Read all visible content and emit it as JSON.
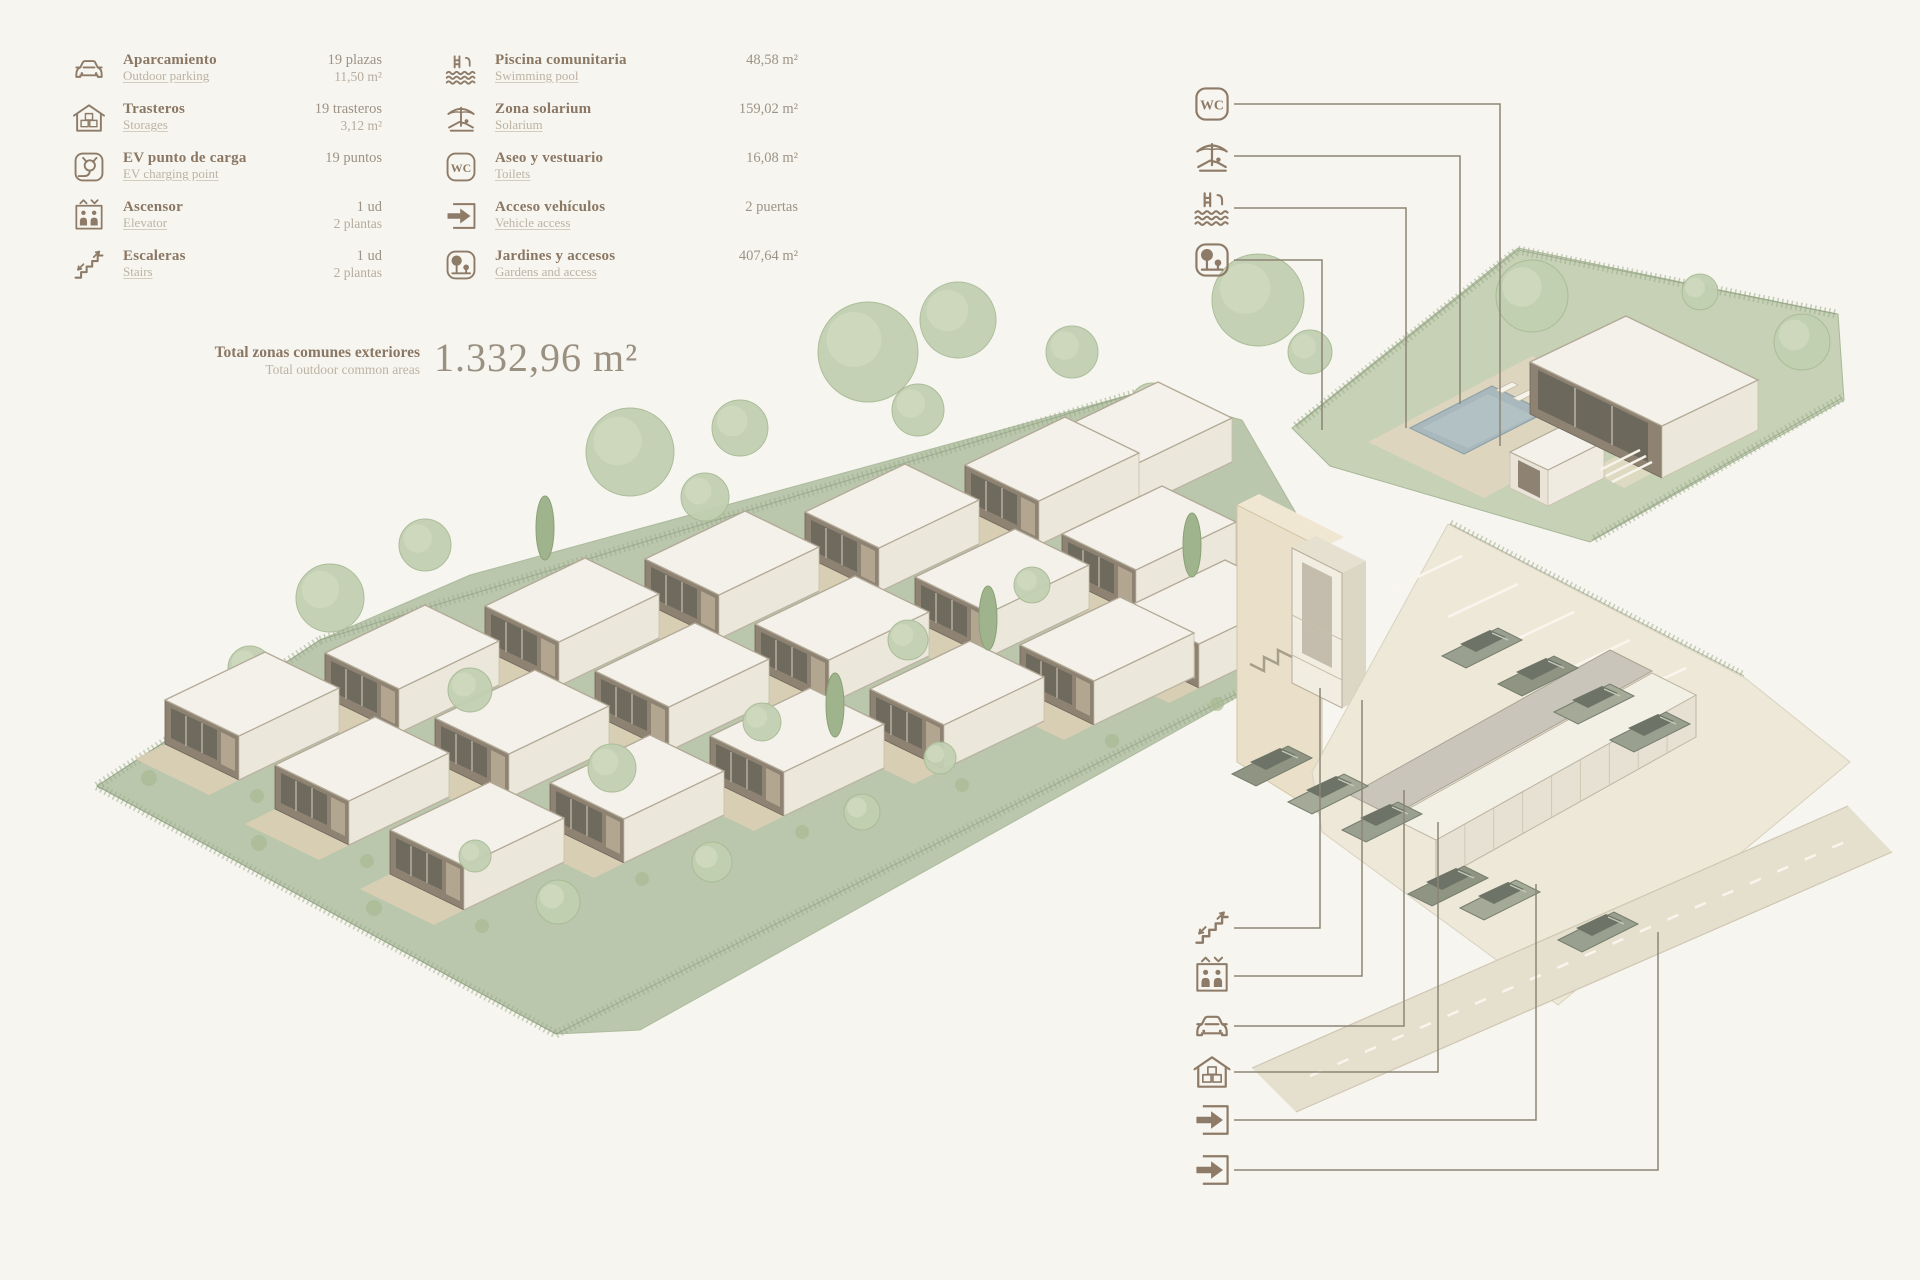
{
  "legend": {
    "col1": [
      {
        "icon": "car-icon",
        "title": "Aparcamiento",
        "subtitle": "Outdoor parking",
        "value1": "19 plazas",
        "value2": "11,50 m²"
      },
      {
        "icon": "storage-icon",
        "title": "Trasteros",
        "subtitle": "Storages",
        "value1": "19 trasteros",
        "value2": "3,12 m²"
      },
      {
        "icon": "ev-icon",
        "title": "EV punto de carga",
        "subtitle": "EV charging point",
        "value1": "19 puntos",
        "value2": ""
      },
      {
        "icon": "elevator-icon",
        "title": "Ascensor",
        "subtitle": "Elevator",
        "value1": "1 ud",
        "value2": "2 plantas"
      },
      {
        "icon": "stairs-icon",
        "title": "Escaleras",
        "subtitle": "Stairs",
        "value1": "1 ud",
        "value2": "2 plantas"
      }
    ],
    "col2": [
      {
        "icon": "pool-icon",
        "title": "Piscina comunitaria",
        "subtitle": "Swimming pool",
        "value1": "48,58 m²",
        "value2": ""
      },
      {
        "icon": "solarium-icon",
        "title": "Zona solarium",
        "subtitle": "Solarium",
        "value1": "159,02 m²",
        "value2": ""
      },
      {
        "icon": "wc-icon",
        "title": "Aseo y vestuario",
        "subtitle": "Toilets",
        "value1": "16,08 m²",
        "value2": ""
      },
      {
        "icon": "vehicle-access-icon",
        "title": "Acceso vehículos",
        "subtitle": "Vehicle access",
        "value1": "2 puertas",
        "value2": ""
      },
      {
        "icon": "garden-icon",
        "title": "Jardines y accesos",
        "subtitle": "Gardens and access",
        "value1": "407,64 m²",
        "value2": ""
      }
    ],
    "total": {
      "title": "Total zonas comunes exteriores",
      "subtitle": "Total outdoor common areas",
      "value": "1.332,96 m²"
    }
  },
  "colors": {
    "accent_brown": "#8d7b68",
    "terrain_green": "#bac7ac",
    "tree_green": "#c2d0b2",
    "roof_white": "#f4f1ea",
    "pool_blue": "#a9b8bd",
    "wall_beige": "#eadfc8",
    "car_grey": "#9aa08f",
    "line": "#8b8575"
  },
  "callouts": {
    "top": [
      {
        "icon": "wc-icon",
        "line": [
          [
            1234,
            104
          ],
          [
            1500,
            104
          ],
          [
            1500,
            446
          ]
        ]
      },
      {
        "icon": "solarium-icon",
        "line": [
          [
            1234,
            156
          ],
          [
            1460,
            156
          ],
          [
            1460,
            404
          ]
        ]
      },
      {
        "icon": "pool-icon",
        "line": [
          [
            1234,
            208
          ],
          [
            1406,
            208
          ],
          [
            1406,
            428
          ]
        ]
      },
      {
        "icon": "garden-icon",
        "line": [
          [
            1234,
            260
          ],
          [
            1322,
            260
          ],
          [
            1322,
            430
          ]
        ]
      }
    ],
    "bottom": [
      {
        "icon": "stairs-icon",
        "line": [
          [
            1234,
            928
          ],
          [
            1320,
            928
          ],
          [
            1320,
            688
          ]
        ]
      },
      {
        "icon": "elevator-icon",
        "line": [
          [
            1234,
            976
          ],
          [
            1362,
            976
          ],
          [
            1362,
            700
          ]
        ]
      },
      {
        "icon": "car-icon",
        "line": [
          [
            1234,
            1026
          ],
          [
            1404,
            1026
          ],
          [
            1404,
            790
          ]
        ]
      },
      {
        "icon": "storage-icon",
        "line": [
          [
            1234,
            1072
          ],
          [
            1438,
            1072
          ],
          [
            1438,
            822
          ]
        ]
      },
      {
        "icon": "vehicle-access-icon",
        "line": [
          [
            1234,
            1120
          ],
          [
            1536,
            1120
          ],
          [
            1536,
            884
          ]
        ]
      },
      {
        "icon": "vehicle-access-icon",
        "line": [
          [
            1234,
            1170
          ],
          [
            1658,
            1170
          ],
          [
            1658,
            932
          ]
        ]
      }
    ],
    "top_icon_x": 1190,
    "top_icon_ys": [
      82,
      134,
      186,
      238
    ],
    "bottom_icon_x": 1190,
    "bottom_icon_ys": [
      906,
      954,
      1004,
      1050,
      1098,
      1148
    ]
  },
  "site": {
    "band": [
      [
        97,
        786
      ],
      [
        320,
        640
      ],
      [
        470,
        575
      ],
      [
        1140,
        392
      ],
      [
        1242,
        420
      ],
      [
        1322,
        558
      ],
      [
        1300,
        662
      ],
      [
        640,
        1030
      ],
      [
        556,
        1034
      ]
    ],
    "community": [
      [
        1292,
        428
      ],
      [
        1518,
        248
      ],
      [
        1700,
        286
      ],
      [
        1838,
        314
      ],
      [
        1844,
        400
      ],
      [
        1590,
        542
      ],
      [
        1330,
        466
      ]
    ],
    "deck": [
      [
        1368,
        442
      ],
      [
        1532,
        356
      ],
      [
        1648,
        408
      ],
      [
        1484,
        498
      ]
    ],
    "pool": [
      [
        1410,
        428
      ],
      [
        1492,
        386
      ],
      [
        1546,
        412
      ],
      [
        1464,
        454
      ]
    ],
    "steps_patch": [
      [
        1590,
        470
      ],
      [
        1666,
        430
      ],
      [
        1700,
        448
      ],
      [
        1624,
        488
      ]
    ],
    "loungers": [
      [
        1496,
        390
      ],
      [
        1513,
        398
      ],
      [
        1530,
        407
      ],
      [
        1547,
        415
      ]
    ],
    "houses": [
      [
        165,
        700
      ],
      [
        325,
        653
      ],
      [
        485,
        606
      ],
      [
        645,
        559
      ],
      [
        805,
        512
      ],
      [
        965,
        465
      ],
      [
        1058,
        430
      ],
      [
        275,
        765
      ],
      [
        435,
        718
      ],
      [
        595,
        671
      ],
      [
        755,
        624
      ],
      [
        915,
        577
      ],
      [
        1062,
        534
      ],
      [
        390,
        830
      ],
      [
        550,
        783
      ],
      [
        710,
        736
      ],
      [
        870,
        689
      ],
      [
        1020,
        645
      ],
      [
        1125,
        608
      ]
    ],
    "trees_back": [
      [
        330,
        598,
        34
      ],
      [
        425,
        545,
        26
      ],
      [
        630,
        452,
        44
      ],
      [
        705,
        497,
        24
      ],
      [
        740,
        428,
        28
      ],
      [
        868,
        352,
        50
      ],
      [
        918,
        410,
        26
      ],
      [
        958,
        320,
        38
      ],
      [
        1072,
        352,
        26
      ],
      [
        1152,
        405,
        22
      ],
      [
        1258,
        300,
        46
      ],
      [
        250,
        668,
        22
      ],
      [
        1310,
        352,
        22
      ]
    ],
    "trees_front": [
      [
        470,
        690,
        22
      ],
      [
        612,
        768,
        24
      ],
      [
        762,
        722,
        19
      ],
      [
        908,
        640,
        20
      ],
      [
        1032,
        585,
        18
      ],
      [
        558,
        902,
        22
      ],
      [
        712,
        862,
        20
      ],
      [
        862,
        812,
        18
      ],
      [
        475,
        856,
        16
      ],
      [
        940,
        758,
        16
      ],
      [
        1532,
        296,
        36
      ],
      [
        1802,
        342,
        28
      ],
      [
        1700,
        292,
        18
      ]
    ],
    "cypresses": [
      [
        545,
        528
      ],
      [
        988,
        618
      ],
      [
        1192,
        545
      ],
      [
        835,
        705
      ]
    ],
    "fences": [
      [
        [
          320,
          640
        ],
        [
          1140,
          392
        ]
      ],
      [
        [
          97,
          786
        ],
        [
          320,
          640
        ]
      ],
      [
        [
          97,
          786
        ],
        [
          556,
          1034
        ]
      ],
      [
        [
          556,
          1034
        ],
        [
          1300,
          662
        ]
      ],
      [
        [
          1296,
          426
        ],
        [
          1518,
          250
        ]
      ],
      [
        [
          1518,
          250
        ],
        [
          1836,
          314
        ]
      ],
      [
        [
          1842,
          398
        ],
        [
          1592,
          540
        ]
      ],
      [
        [
          1450,
          524
        ],
        [
          1744,
          676
        ]
      ]
    ],
    "parking": [
      [
        1312,
        772
      ],
      [
        1448,
        524
      ],
      [
        1745,
        678
      ],
      [
        1850,
        762
      ],
      [
        1558,
        1005
      ],
      [
        1322,
        832
      ]
    ],
    "road": [
      [
        1252,
        1068
      ],
      [
        1848,
        806
      ],
      [
        1892,
        852
      ],
      [
        1296,
        1112
      ]
    ],
    "stalls": [
      [
        1462,
        556
      ],
      [
        1518,
        584
      ],
      [
        1574,
        612
      ],
      [
        1630,
        640
      ],
      [
        1686,
        668
      ]
    ],
    "cars": [
      [
        1482,
        648
      ],
      [
        1538,
        676
      ],
      [
        1594,
        704
      ],
      [
        1650,
        732
      ],
      [
        1272,
        766
      ],
      [
        1328,
        794
      ],
      [
        1382,
        822
      ],
      [
        1448,
        886
      ],
      [
        1500,
        900
      ],
      [
        1598,
        932
      ]
    ]
  }
}
